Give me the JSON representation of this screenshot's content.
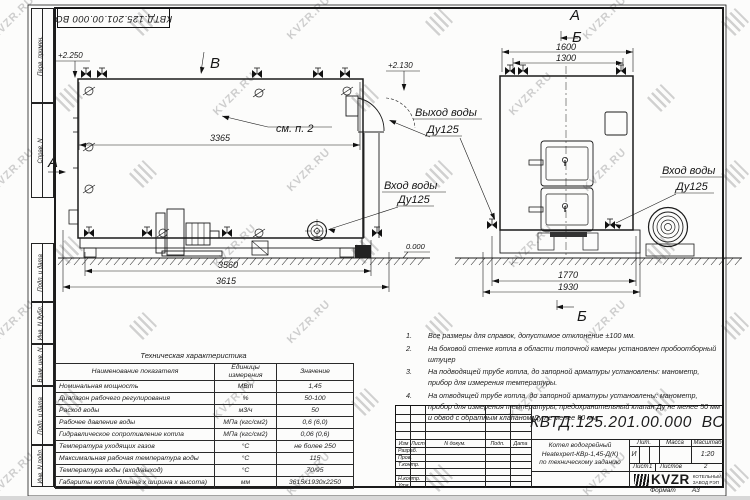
{
  "watermark_text": "KVZR.RU",
  "frame": {
    "side_labels": [
      "Перв. примен.",
      "Справ. N",
      "Подп. и дата",
      "Инв. N дубл.",
      "Взам. инв. N",
      "Подп. и дата",
      "Инв. N подл."
    ]
  },
  "drawing": {
    "left_view": {
      "view_b": "В",
      "section_a": "А",
      "elev_top": "+2.250",
      "elev_zero": "0.000",
      "see_note": "см. п. 2",
      "dim_width": "3365",
      "dim_base": "3560",
      "dim_total": "3615",
      "inlet_1": "Вход воды",
      "inlet_2": "Ду125"
    },
    "right_view": {
      "label_a": "А",
      "label_b_top": "Б",
      "label_b_bottom": "Б",
      "elev_flue": "+2.130",
      "dim_1600": "1600",
      "dim_1300": "1300",
      "dim_1770": "1770",
      "dim_1930": "1930",
      "outlet_1": "Выход воды",
      "outlet_2": "Ду125",
      "inlet_1": "Вход воды",
      "inlet_2": "Ду125"
    }
  },
  "notes": [
    {
      "num": "1.",
      "text": "Все размеры для справок, допустимое отклонение ±100 мм."
    },
    {
      "num": "2.",
      "text": "На боковой стенке котла в области топочной камеры установлен пробоотборный штуцер"
    },
    {
      "num": "3.",
      "text": "На  подводящей трубе котла, до запорной арматуры установлены: манометр, прибор для измерения температуры."
    },
    {
      "num": "4.",
      "text": "На отводящей трубе котла, до запорной арматуры установлены: манометр, прибор для измерения температуры, предохранительный клапан Ду не менее 50 мм и обвод с обратным клапаном Ду не менее 50 мм."
    }
  ],
  "tech_table": {
    "title": "Техническая характеристика",
    "headers": [
      "Наименование показателя",
      "Единицы\nизмерения",
      "Значение"
    ],
    "rows": [
      [
        "Номинальная мощность",
        "МВт",
        "1,45"
      ],
      [
        "Диапазон рабочего регулирования",
        "%",
        "50-100"
      ],
      [
        "Расход воды",
        "м3/ч",
        "50"
      ],
      [
        "Рабочее давление воды",
        "МПа (кгс/см2)",
        "0,6 (6,0)"
      ],
      [
        "Гидравлическое сопротивление котла",
        "МПа (кгс/см2)",
        "0,06 (0,6)"
      ],
      [
        "Температура уходящих газов",
        "°С",
        "не более 250"
      ],
      [
        "Максимальная рабочая температура воды",
        "°С",
        "115"
      ],
      [
        "Температура воды (вход/выход)",
        "°С",
        "70/95"
      ],
      [
        "Габариты котла (длинна х ширина х высота)",
        "мм",
        "3615х1930х2250"
      ]
    ]
  },
  "title_block": {
    "designation": "КВТД.125.201.00.000  ВО",
    "sig_headers": [
      "Изм",
      "Лист",
      "N докум.",
      "Подп.",
      "Дата"
    ],
    "sig_rows": [
      "Разраб.",
      "Пров.",
      "Т.контр.",
      "",
      "Н.контр.",
      "Утв."
    ],
    "doc_name_lines": [
      "Котел водогрейный",
      "Heatexpert-КВр-1,45-Д(К)",
      "по техническому заданию"
    ],
    "lit_label": "Лит.",
    "lit_value": "И",
    "mass_label": "Масса",
    "scale_label": "Масштаб",
    "scale_value": "1:20",
    "sheet_label": "Лист",
    "sheet_value": "1",
    "sheets_label": "Листов",
    "sheets_value": "2",
    "logo_text": "KVZR",
    "company": "КОТЕЛЬНЫЙ\nЗАВОД РЭП",
    "format_label": "Формат",
    "format_value": "А3"
  }
}
